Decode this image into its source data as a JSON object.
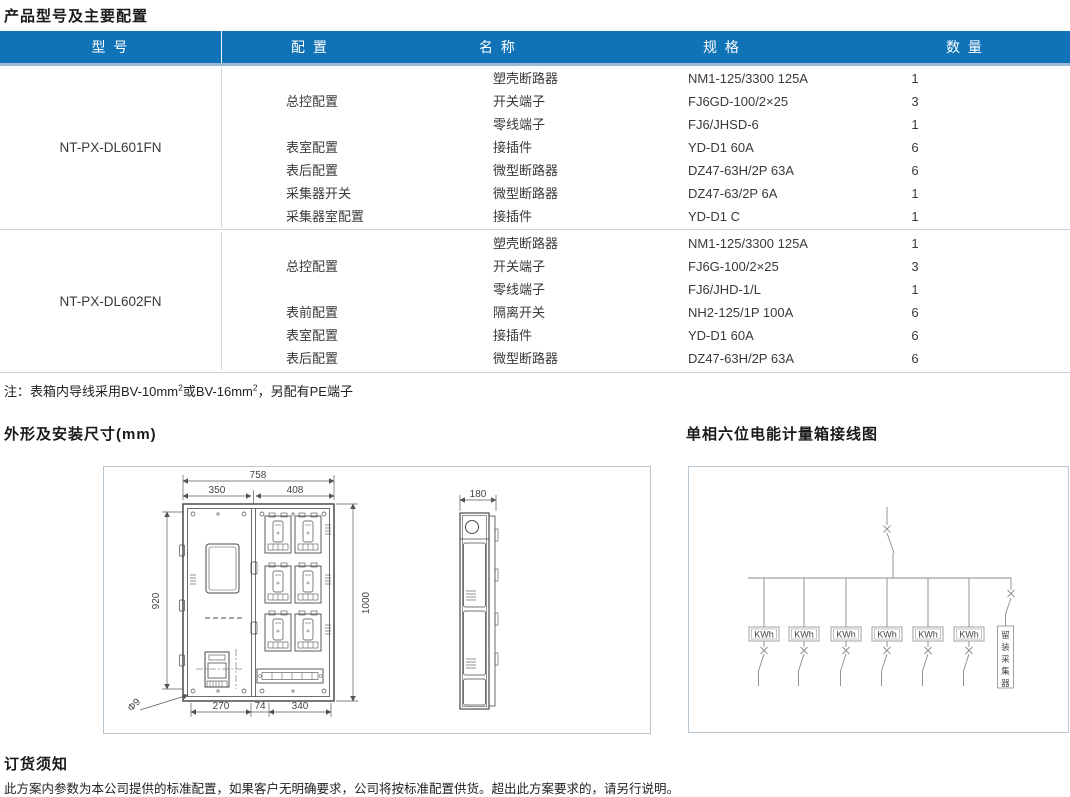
{
  "page": {
    "title": "产品型号及主要配置"
  },
  "table": {
    "headers": [
      "型 号",
      "配 置",
      "名 称",
      "规 格",
      "数 量"
    ],
    "groups": [
      {
        "model": "NT-PX-DL601FN",
        "configs": [
          {
            "label": "总控配置",
            "span": 3
          },
          {
            "label": "表室配置",
            "span": 1
          },
          {
            "label": "表后配置",
            "span": 1
          },
          {
            "label": "采集器开关",
            "span": 1
          },
          {
            "label": "采集器室配置",
            "span": 1
          }
        ],
        "rows": [
          {
            "name": "塑壳断路器",
            "spec": "NM1-125/3300 125A",
            "qty": "1"
          },
          {
            "name": "开关端子",
            "spec": "FJ6GD-100/2×25",
            "qty": "3"
          },
          {
            "name": "零线端子",
            "spec": "FJ6/JHSD-6",
            "qty": "1"
          },
          {
            "name": "接插件",
            "spec": "YD-D1 60A",
            "qty": "6"
          },
          {
            "name": "微型断路器",
            "spec": "DZ47-63H/2P 63A",
            "qty": "6"
          },
          {
            "name": "微型断路器",
            "spec": "DZ47-63/2P 6A",
            "qty": "1"
          },
          {
            "name": "接插件",
            "spec": "YD-D1 C",
            "qty": "1"
          }
        ]
      },
      {
        "model": "NT-PX-DL602FN",
        "configs": [
          {
            "label": "总控配置",
            "span": 3
          },
          {
            "label": "表前配置",
            "span": 1
          },
          {
            "label": "表室配置",
            "span": 1
          },
          {
            "label": "表后配置",
            "span": 1
          }
        ],
        "rows": [
          {
            "name": "塑壳断路器",
            "spec": "NM1-125/3300 125A",
            "qty": "1"
          },
          {
            "name": "开关端子",
            "spec": "FJ6G-100/2×25",
            "qty": "3"
          },
          {
            "name": "零线端子",
            "spec": "FJ6/JHD-1/L",
            "qty": "1"
          },
          {
            "name": "隔离开关",
            "spec": "NH2-125/1P 100A",
            "qty": "6"
          },
          {
            "name": "接插件",
            "spec": "YD-D1 60A",
            "qty": "6"
          },
          {
            "name": "微型断路器",
            "spec": "DZ47-63H/2P 63A",
            "qty": "6"
          }
        ]
      }
    ]
  },
  "note": {
    "part1": "注：表箱内导线采用BV-10mm",
    "sup1": "2",
    "part2": "或BV-16mm",
    "sup2": "2",
    "part3": "，另配有PE端子"
  },
  "sections": {
    "dimensions_title": "外形及安装尺寸(mm)",
    "wiring_title": "单相六位电能计量箱接线图",
    "order_title": "订货须知",
    "order_text": "此方案内参数为本公司提供的标准配置，如果客户无明确要求，公司将按标准配置供货。超出此方案要求的，请另行说明。"
  },
  "drawing_dims": {
    "width_total": "758",
    "width_left": "350",
    "width_right": "408",
    "height_left": "920",
    "height_right": "1000",
    "bottom_left": "270",
    "bottom_mid": "74",
    "bottom_right": "340",
    "hole": "Φ9",
    "side_depth": "180"
  },
  "wiring": {
    "meter_label": "KWh",
    "collector_label": "留装采集器",
    "collector_chars": [
      "留",
      "装",
      "采",
      "集",
      "器"
    ]
  },
  "colors": {
    "header_bg": "#1173b7",
    "header_edge": "#9db9d8",
    "table_border": "#cdd2d6",
    "panel_border": "#b9c7d3",
    "text": "#333333"
  }
}
